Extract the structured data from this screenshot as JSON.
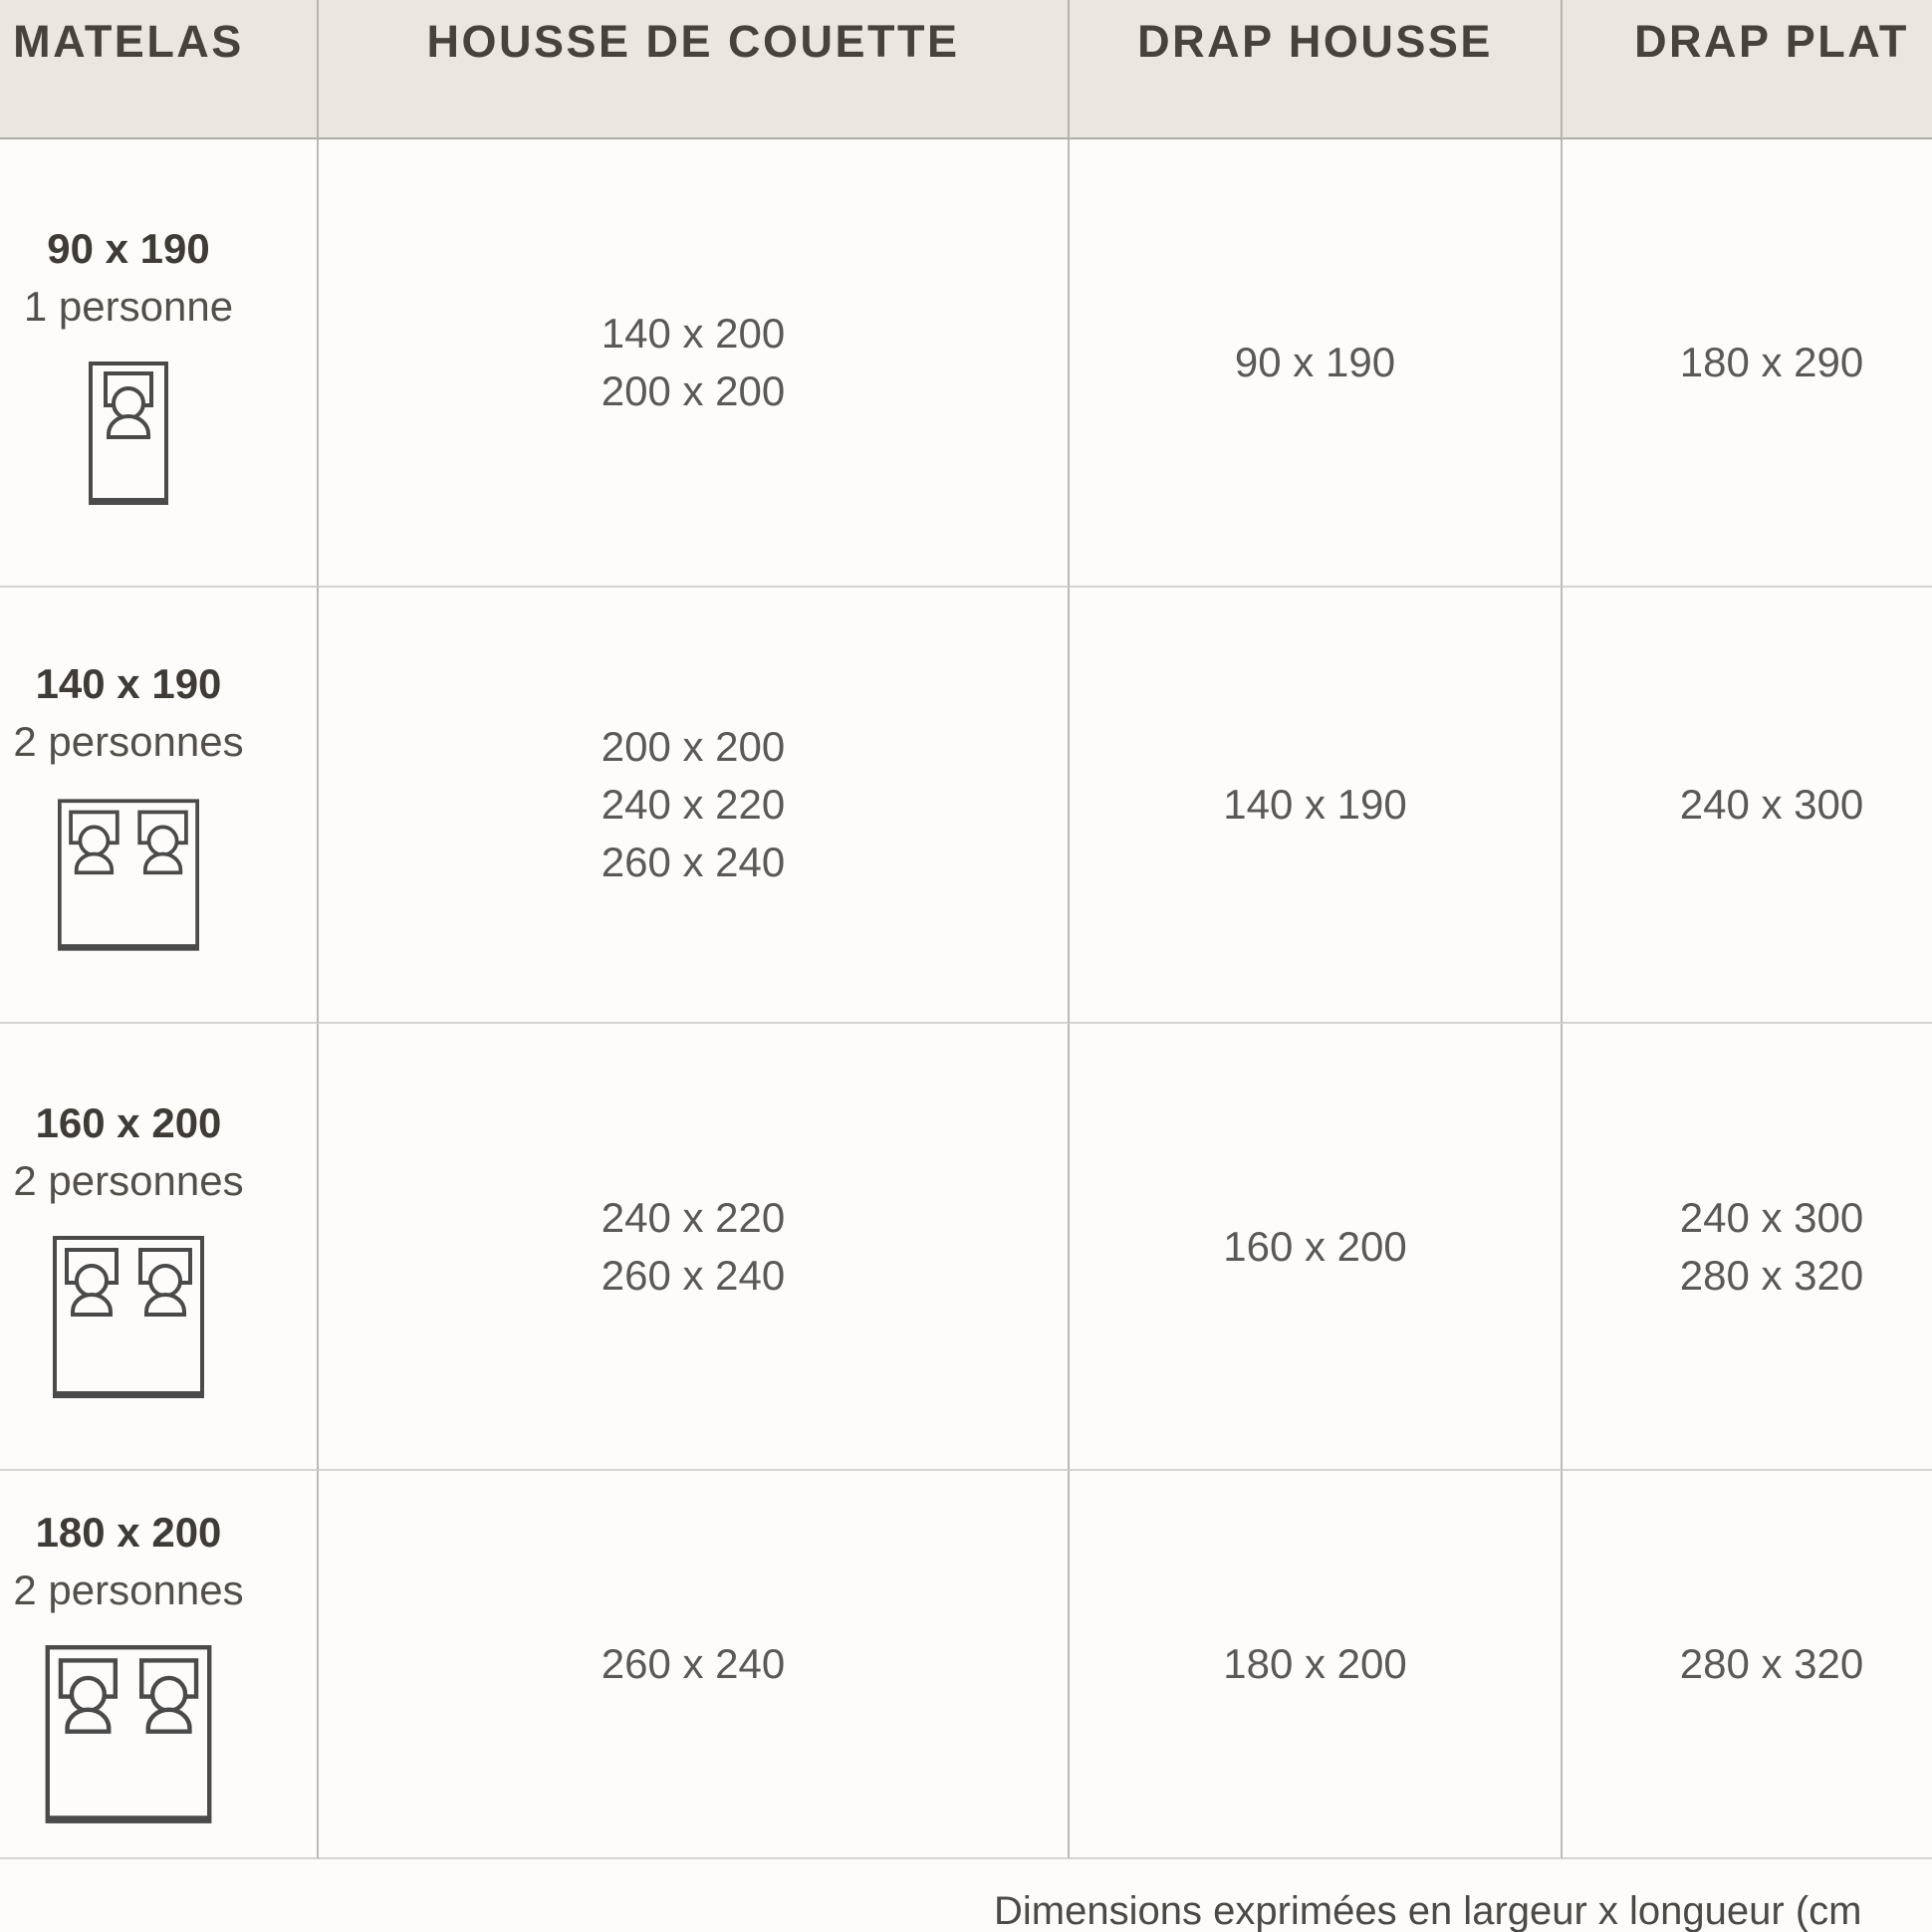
{
  "table": {
    "columns": [
      {
        "id": "matelas",
        "label": "MATELAS"
      },
      {
        "id": "housse_de_couette",
        "label": "HOUSSE DE COUETTE"
      },
      {
        "id": "drap_housse",
        "label": "DRAP HOUSSE"
      },
      {
        "id": "drap_plat",
        "label": "DRAP PLAT"
      }
    ],
    "rows": [
      {
        "matelas": {
          "size": "90 x 190",
          "capacity": "1 personne",
          "icon": "single-bed-icon"
        },
        "housse_de_couette": [
          "140 x 200",
          "200 x 200"
        ],
        "drap_housse": [
          "90 x 190"
        ],
        "drap_plat": [
          "180 x 290"
        ]
      },
      {
        "matelas": {
          "size": "140 x 190",
          "capacity": "2 personnes",
          "icon": "double-bed-icon"
        },
        "housse_de_couette": [
          "200 x 200",
          "240 x 220",
          "260 x 240"
        ],
        "drap_housse": [
          "140 x 190"
        ],
        "drap_plat": [
          "240 x 300"
        ]
      },
      {
        "matelas": {
          "size": "160 x 200",
          "capacity": "2 personnes",
          "icon": "double-bed-icon"
        },
        "housse_de_couette": [
          "240 x 220",
          "260 x 240"
        ],
        "drap_housse": [
          "160 x 200"
        ],
        "drap_plat": [
          "240 x 300",
          "280 x 320"
        ]
      },
      {
        "matelas": {
          "size": "180 x 200",
          "capacity": "2 personnes",
          "icon": "double-bed-icon"
        },
        "housse_de_couette": [
          "260 x 240"
        ],
        "drap_housse": [
          "180 x 200"
        ],
        "drap_plat": [
          "280 x 320"
        ]
      }
    ]
  },
  "footer": {
    "note": "Dimensions exprimées en largeur x longueur (cm"
  },
  "colors": {
    "header_bg": "#eae6e0",
    "page_bg": "#fdfcfb",
    "grid_line": "#bdbab6",
    "row_line": "#d6d4d1",
    "header_text": "#46423c",
    "cell_text": "#5b5957",
    "bold_text": "#3f3b36",
    "icon_stroke": "#4a4a4a"
  }
}
